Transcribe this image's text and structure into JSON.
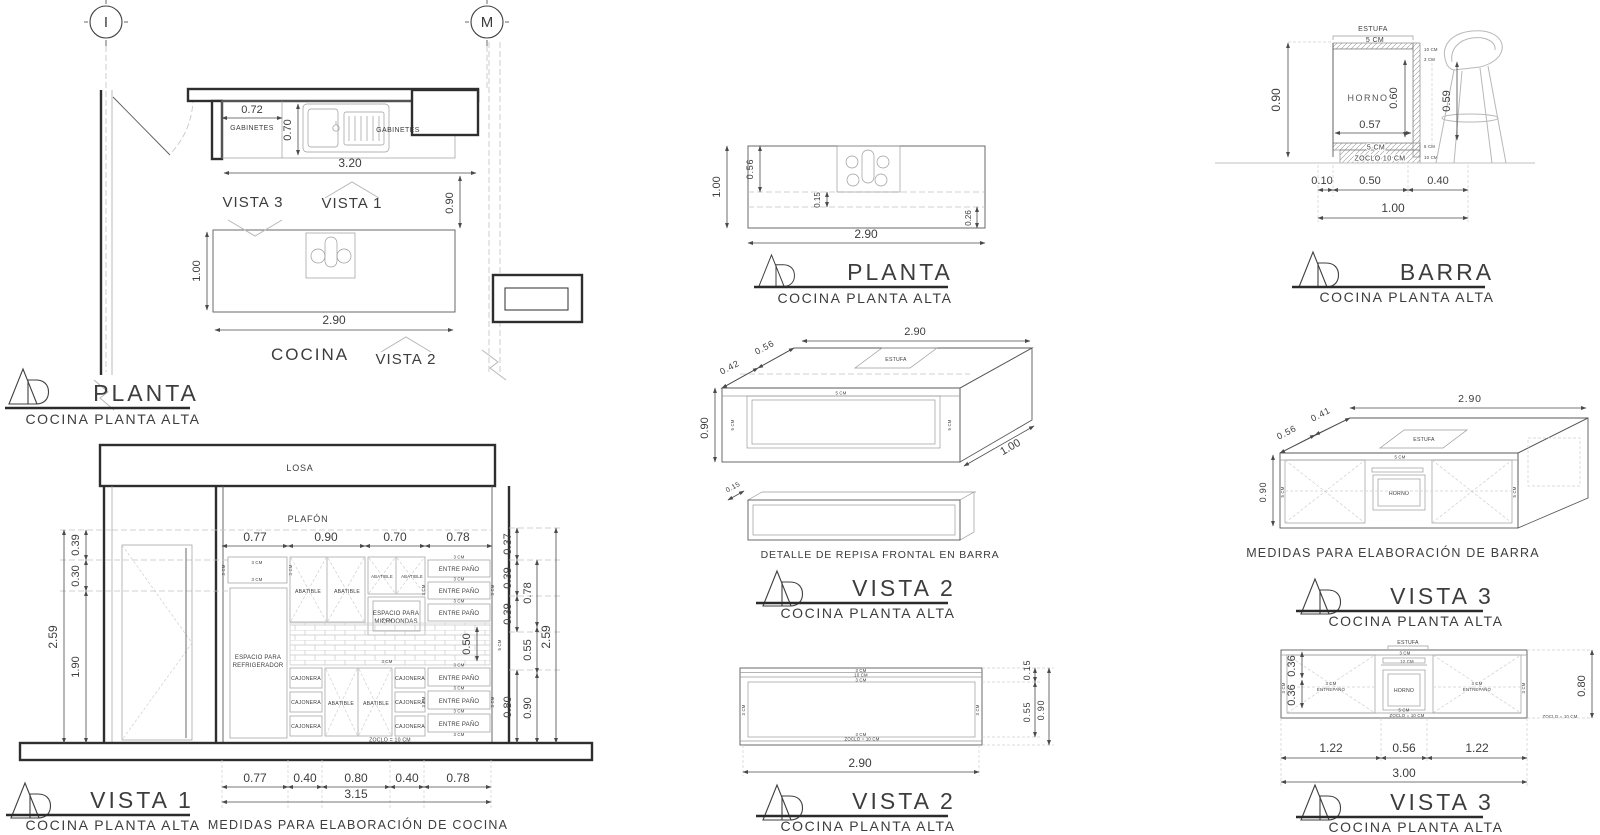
{
  "common": {
    "subtitle": "COCINA PLANTA ALTA",
    "cm3": "3 CM",
    "cm5": "5 CM",
    "cm10": "10 CM",
    "cm12": "12 CM",
    "zoclo_eq": "ZOCLO = 10 CM"
  },
  "plan": {
    "title": "PLANTA",
    "grid_left": "I",
    "grid_right": "M",
    "dim_cab": "0.72",
    "gabinetes": "GABINETES",
    "dim_depth": "0.70",
    "dim_len": "3.20",
    "dim_gap": "0.90",
    "vista1": "VISTA 1",
    "vista2": "VISTA 2",
    "vista3": "VISTA 3",
    "island_w": "1.00",
    "island_l": "2.90",
    "cocina": "COCINA"
  },
  "vista1": {
    "title": "VISTA 1",
    "losa": "LOSA",
    "plafon": "PLAFÓN",
    "dims_top": [
      "0.77",
      "0.90",
      "0.70",
      "0.78"
    ],
    "left_total": "2.59",
    "left_chain": [
      "0.39",
      "0.30",
      "1.90"
    ],
    "right_chain1": [
      "0.37",
      "0.39",
      "0.39",
      "0.80"
    ],
    "right_chain2": [
      "0.78",
      "0.55",
      "0.90"
    ],
    "right_total": "2.59",
    "dim_splash": "0.50",
    "fridge1": "ESPACIO PARA",
    "fridge2": "REFRIGERADOR",
    "abatible": "ABATIBLE",
    "micro1": "ESPACIO PARA",
    "micro2": "MICROONDAS",
    "entrepano": "ENTRE PAÑO",
    "cajonera": "CAJONERA",
    "zoclo": "ZOCLO = 10 CM",
    "dims_bottom": [
      "0.77",
      "0.40",
      "0.80",
      "0.40",
      "0.78"
    ],
    "bottom_total": "3.15",
    "note": "MEDIDAS PARA ELABORACIÓN DE COCINA"
  },
  "planta2": {
    "title": "PLANTA",
    "dim_w": "1.00",
    "dim_stove": "0.56",
    "dim_shelf": "0.15",
    "dim_edge": "0.26",
    "dim_l": "2.90"
  },
  "vista2iso": {
    "title": "VISTA 2",
    "dim_l": "2.90",
    "dim_d1": "0.56",
    "dim_d2": "0.42",
    "dim_h": "0.90",
    "dim_w": "1.00",
    "estufa": "ESTUFA",
    "detail_dim": "0.15",
    "detail": "DETALLE DE REPISA FRONTAL EN BARRA"
  },
  "vista2elev": {
    "title": "VISTA 2",
    "dim_shelf": "0.15",
    "dim_open": "0.55",
    "dim_h": "0.90",
    "dim_l": "2.90"
  },
  "barra": {
    "title": "BARRA",
    "estufa": "ESTUFA",
    "horno": "HORNO",
    "dim_h": "0.90",
    "dim_oven_h": "0.60",
    "dim_clear": "0.59",
    "dim_oven_w": "0.57",
    "zoclo": "ZOCLO 10 CM",
    "dims_bottom": [
      "0.10",
      "0.50",
      "0.40"
    ],
    "total": "1.00"
  },
  "vista3iso": {
    "title": "VISTA 3",
    "dim_l": "2.90",
    "dim_d1": "0.41",
    "dim_d2": "0.56",
    "dim_h": "0.90",
    "estufa": "ESTUFA",
    "horno": "HORNO",
    "note": "MEDIDAS PARA ELABORACIÓN DE BARRA"
  },
  "vista3elev": {
    "title": "VISTA 3",
    "estufa": "ESTUFA",
    "horno": "HORNO",
    "entrepano": "ENTREPAÑO",
    "left_dims": [
      "0.36",
      "0.36"
    ],
    "dim_right": "0.80",
    "dims_bottom": [
      "1.22",
      "0.56",
      "1.22"
    ],
    "total": "3.00"
  }
}
